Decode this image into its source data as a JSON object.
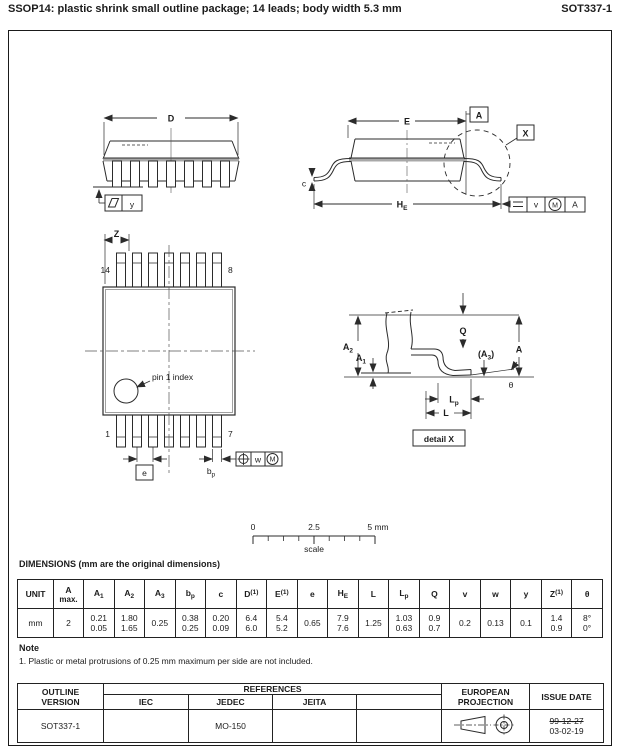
{
  "header": {
    "title": "SSOP14: plastic shrink small outline package; 14 leads; body width 5.3 mm",
    "doc_id": "SOT337-1"
  },
  "drawing": {
    "d_label": "D",
    "y_datum": "y",
    "e_label": "E",
    "a_datum": "A",
    "x_label": "X",
    "he_h": "H",
    "he_e": "E",
    "c_label": "c",
    "frame1": {
      "v": "v",
      "m": "M",
      "a": "A"
    },
    "z_label": "Z",
    "pin14": "14",
    "pin8": "8",
    "pin1": "1",
    "pin7": "7",
    "pin1_index": "pin 1 index",
    "e_pitch": "e",
    "bp_b": "b",
    "bp_p": "p",
    "frame2": {
      "w": "w",
      "m": "M"
    },
    "a2_b": "A",
    "a2_s": "2",
    "a1_b": "A",
    "a1_s": "1",
    "q_label": "Q",
    "a3_open": "(A",
    "a3_s": "3",
    "a3_close": ")",
    "a_right": "A",
    "theta": "θ",
    "lp_b": "L",
    "lp_p": "p",
    "l_label": "L",
    "detail_x": "detail X",
    "scale": {
      "t0": "0",
      "t1": "2.5",
      "t2": "5 mm",
      "label": "scale"
    }
  },
  "dim_table": {
    "title": "DIMENSIONS (mm are the original dimensions)",
    "headers": [
      {
        "b": "UNIT"
      },
      {
        "b": "A",
        "l2": "max."
      },
      {
        "b": "A",
        "s": "1"
      },
      {
        "b": "A",
        "s": "2"
      },
      {
        "b": "A",
        "s": "3"
      },
      {
        "b": "b",
        "s": "p"
      },
      {
        "b": "c"
      },
      {
        "b": "D",
        "p": "(1)"
      },
      {
        "b": "E",
        "p": "(1)"
      },
      {
        "b": "e"
      },
      {
        "b": "H",
        "s": "E"
      },
      {
        "b": "L"
      },
      {
        "b": "L",
        "s": "p"
      },
      {
        "b": "Q"
      },
      {
        "b": "v"
      },
      {
        "b": "w"
      },
      {
        "b": "y"
      },
      {
        "b": "Z",
        "p": "(1)"
      },
      {
        "b": "θ"
      }
    ],
    "values": [
      [
        "mm"
      ],
      [
        "2"
      ],
      [
        "0.21",
        "0.05"
      ],
      [
        "1.80",
        "1.65"
      ],
      [
        "0.25"
      ],
      [
        "0.38",
        "0.25"
      ],
      [
        "0.20",
        "0.09"
      ],
      [
        "6.4",
        "6.0"
      ],
      [
        "5.4",
        "5.2"
      ],
      [
        "0.65"
      ],
      [
        "7.9",
        "7.6"
      ],
      [
        "1.25"
      ],
      [
        "1.03",
        "0.63"
      ],
      [
        "0.9",
        "0.7"
      ],
      [
        "0.2"
      ],
      [
        "0.13"
      ],
      [
        "0.1"
      ],
      [
        "1.4",
        "0.9"
      ],
      [
        "8°",
        "0°"
      ]
    ]
  },
  "note": {
    "heading": "Note",
    "item": "1. Plastic or metal protrusions of 0.25 mm maximum per side are not included."
  },
  "footer": {
    "outline_l1": "OUTLINE",
    "outline_l2": "VERSION",
    "references": "REFERENCES",
    "ref_cols": {
      "iec": "IEC",
      "jedec": "JEDEC",
      "jeita": "JEITA"
    },
    "euro_l1": "EUROPEAN",
    "euro_l2": "PROJECTION",
    "issue": "ISSUE DATE",
    "version_value": "SOT337-1",
    "iec_value": "",
    "jedec_value": "MO-150",
    "jeita_value": "",
    "issue_old": "99-12-27",
    "issue_new": "03-02-19"
  },
  "colors": {
    "line": "#2b2b2b",
    "grey_band": "#a8a8a8"
  }
}
